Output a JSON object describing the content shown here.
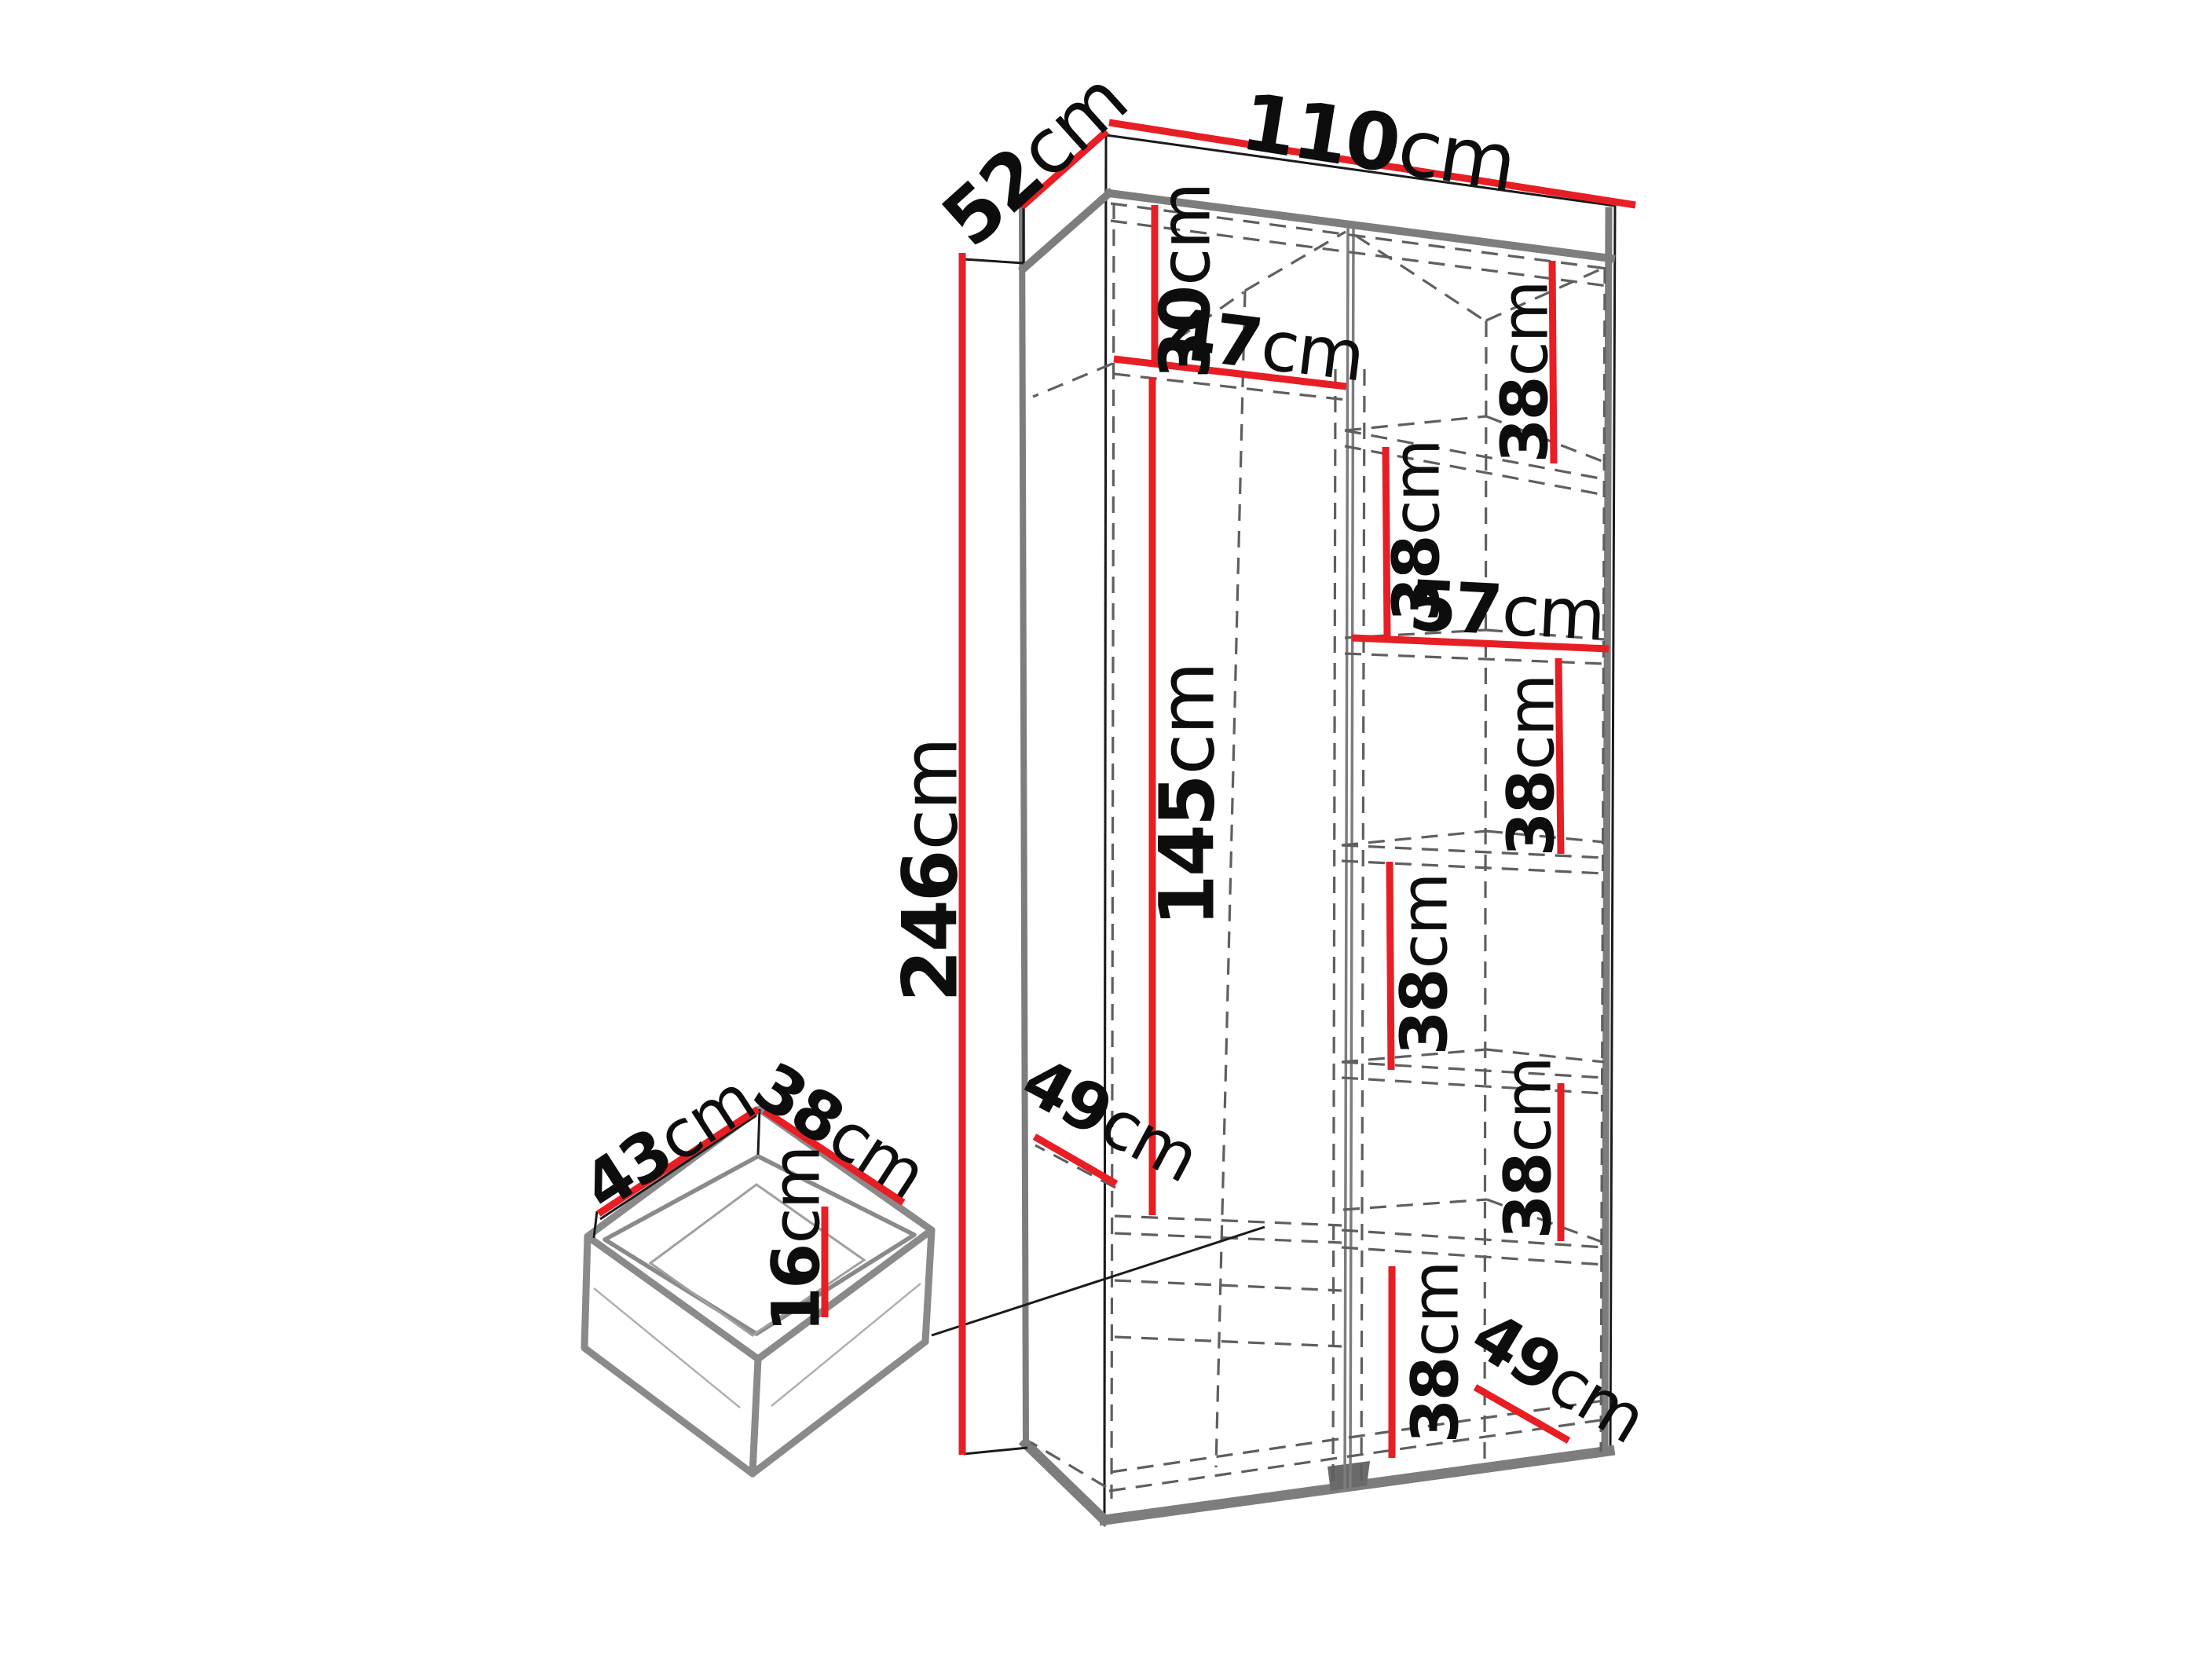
{
  "page": {
    "type": "wardrobe assembly dimension diagram",
    "background": "#ffffff"
  },
  "colors": {
    "dimension_red": "#e81e25",
    "outline_black": "#1a1a1a",
    "edge_gray": "#7d7d7d",
    "hidden_line_gray": "#5f5f5f"
  },
  "dimensions": {
    "depth": {
      "num": "52",
      "unit": "cm"
    },
    "width": {
      "num": "110",
      "unit": "cm"
    },
    "height": {
      "num": "246",
      "unit": "cm"
    },
    "top_section": {
      "num": "30",
      "unit": "cm"
    },
    "left_column_width": {
      "num": "47",
      "unit": "cm"
    },
    "hanging_height": {
      "num": "145",
      "unit": "cm"
    },
    "right_column_width": {
      "num": "57",
      "unit": "cm"
    },
    "shelf_gap_top_right": {
      "num": "38",
      "unit": "cm"
    },
    "shelf_gap_upper_mid": {
      "num": "38",
      "unit": "cm"
    },
    "shelf_gap_below_57": {
      "num": "38",
      "unit": "cm"
    },
    "shelf_gap_mid": {
      "num": "38",
      "unit": "cm"
    },
    "shelf_gap_lower": {
      "num": "38",
      "unit": "cm"
    },
    "shelf_gap_bottom": {
      "num": "38",
      "unit": "cm"
    },
    "left_shelf_depth": {
      "num": "49",
      "unit": "cm"
    },
    "bottom_shelf_depth": {
      "num": "49",
      "unit": "cm"
    }
  },
  "drawer": {
    "width": {
      "num": "43",
      "unit": "cm"
    },
    "depth": {
      "num": "38",
      "unit": "cm"
    },
    "height": {
      "num": "16",
      "unit": "cm"
    }
  }
}
